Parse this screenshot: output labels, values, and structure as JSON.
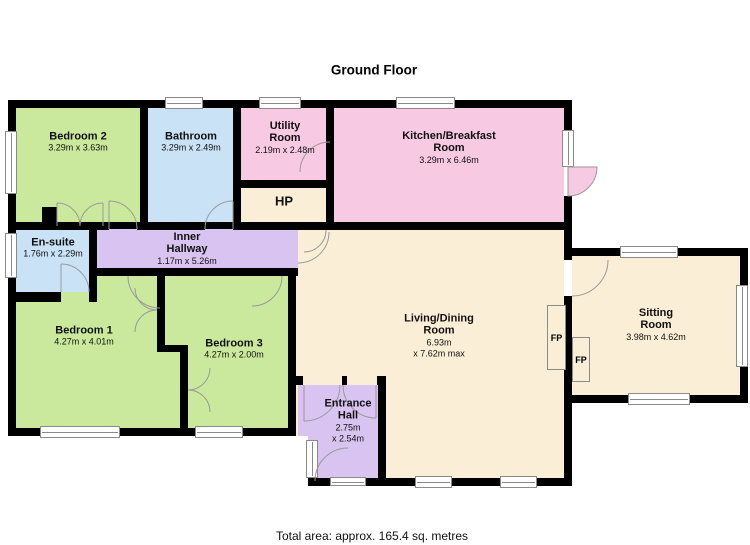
{
  "title": "Ground Floor",
  "footer": "Total area: approx. 165.4 sq. metres",
  "colors": {
    "bedroom_green": "#cbe99c",
    "bath_blue": "#c9e2f5",
    "kitchen_pink": "#f7c9e3",
    "hall_purple": "#d9c3f0",
    "living_cream": "#faeed6",
    "wall_black": "#000000",
    "window_frame": "#8a8a8a",
    "door_arc": "#9a9a9a"
  },
  "rooms": {
    "bedroom2": {
      "name": "Bedroom 2",
      "dims": "3.29m x 3.63m"
    },
    "bathroom": {
      "name": "Bathroom",
      "dims": "3.29m x 2.49m"
    },
    "utility": {
      "name_line1": "Utility",
      "name_line2": "Room",
      "dims": "2.19m x 2.48m"
    },
    "kitchen": {
      "name_line1": "Kitchen/Breakfast",
      "name_line2": "Room",
      "dims": "3.29m x 6.46m"
    },
    "hp": {
      "name": "HP"
    },
    "ensuite": {
      "name": "En-suite",
      "dims": "1.76m x 2.29m"
    },
    "hallway": {
      "name_line1": "Inner",
      "name_line2": "Hallway",
      "dims": "1.17m x 5.26m"
    },
    "bedroom1": {
      "name": "Bedroom 1",
      "dims": "4.27m x 4.01m"
    },
    "bedroom3": {
      "name": "Bedroom 3",
      "dims": "4.27m x 2.00m"
    },
    "living": {
      "name_line1": "Living/Dining",
      "name_line2": "Room",
      "dims_line1": "6.93m",
      "dims_line2": "x 7.62m max"
    },
    "sitting": {
      "name_line1": "Sitting",
      "name_line2": "Room",
      "dims": "3.98m x 4.62m"
    },
    "entrance": {
      "name_line1": "Entrance",
      "name_line2": "Hall",
      "dims_line1": "2.75m",
      "dims_line2": "x 2.54m"
    },
    "fireplace_left": {
      "label": "FP"
    },
    "fireplace_right": {
      "label": "FP"
    }
  }
}
